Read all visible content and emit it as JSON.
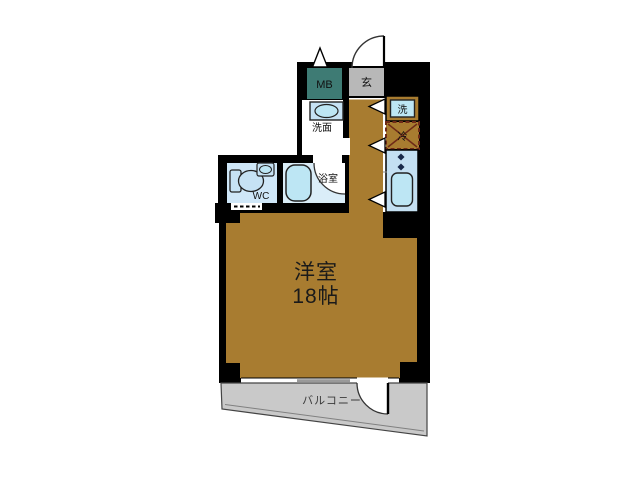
{
  "plan": {
    "type": "apartment-floor-plan",
    "rooms": {
      "main_room": {
        "name": "洋室",
        "size": "18帖"
      },
      "balcony": {
        "label": "バルコニー"
      },
      "entrance": {
        "label": "玄"
      },
      "meter_box": {
        "label": "MB"
      },
      "washroom": {
        "label": "洗面"
      },
      "bathroom": {
        "label": "浴室"
      },
      "toilet": {
        "label": "WC"
      },
      "washer": {
        "label": "洗"
      },
      "fridge": {
        "label": "冷"
      }
    },
    "colors": {
      "wall": "#000000",
      "floor": "#A87C30",
      "balcony": "#C9C9C9",
      "entrance_floor": "#B8B8B8",
      "meter_box": "#3E7B74",
      "wc_floor": "#CFE7F8",
      "bath_floor": "#DAEDF8",
      "kitchen_counter": "#C4E0F2",
      "fixture": "#BDE6F4",
      "fixture_light": "#C6E2F4",
      "fridge_mark": "#6E2A17",
      "window_sash": "#999999",
      "burner": "#1A2A4A"
    }
  }
}
